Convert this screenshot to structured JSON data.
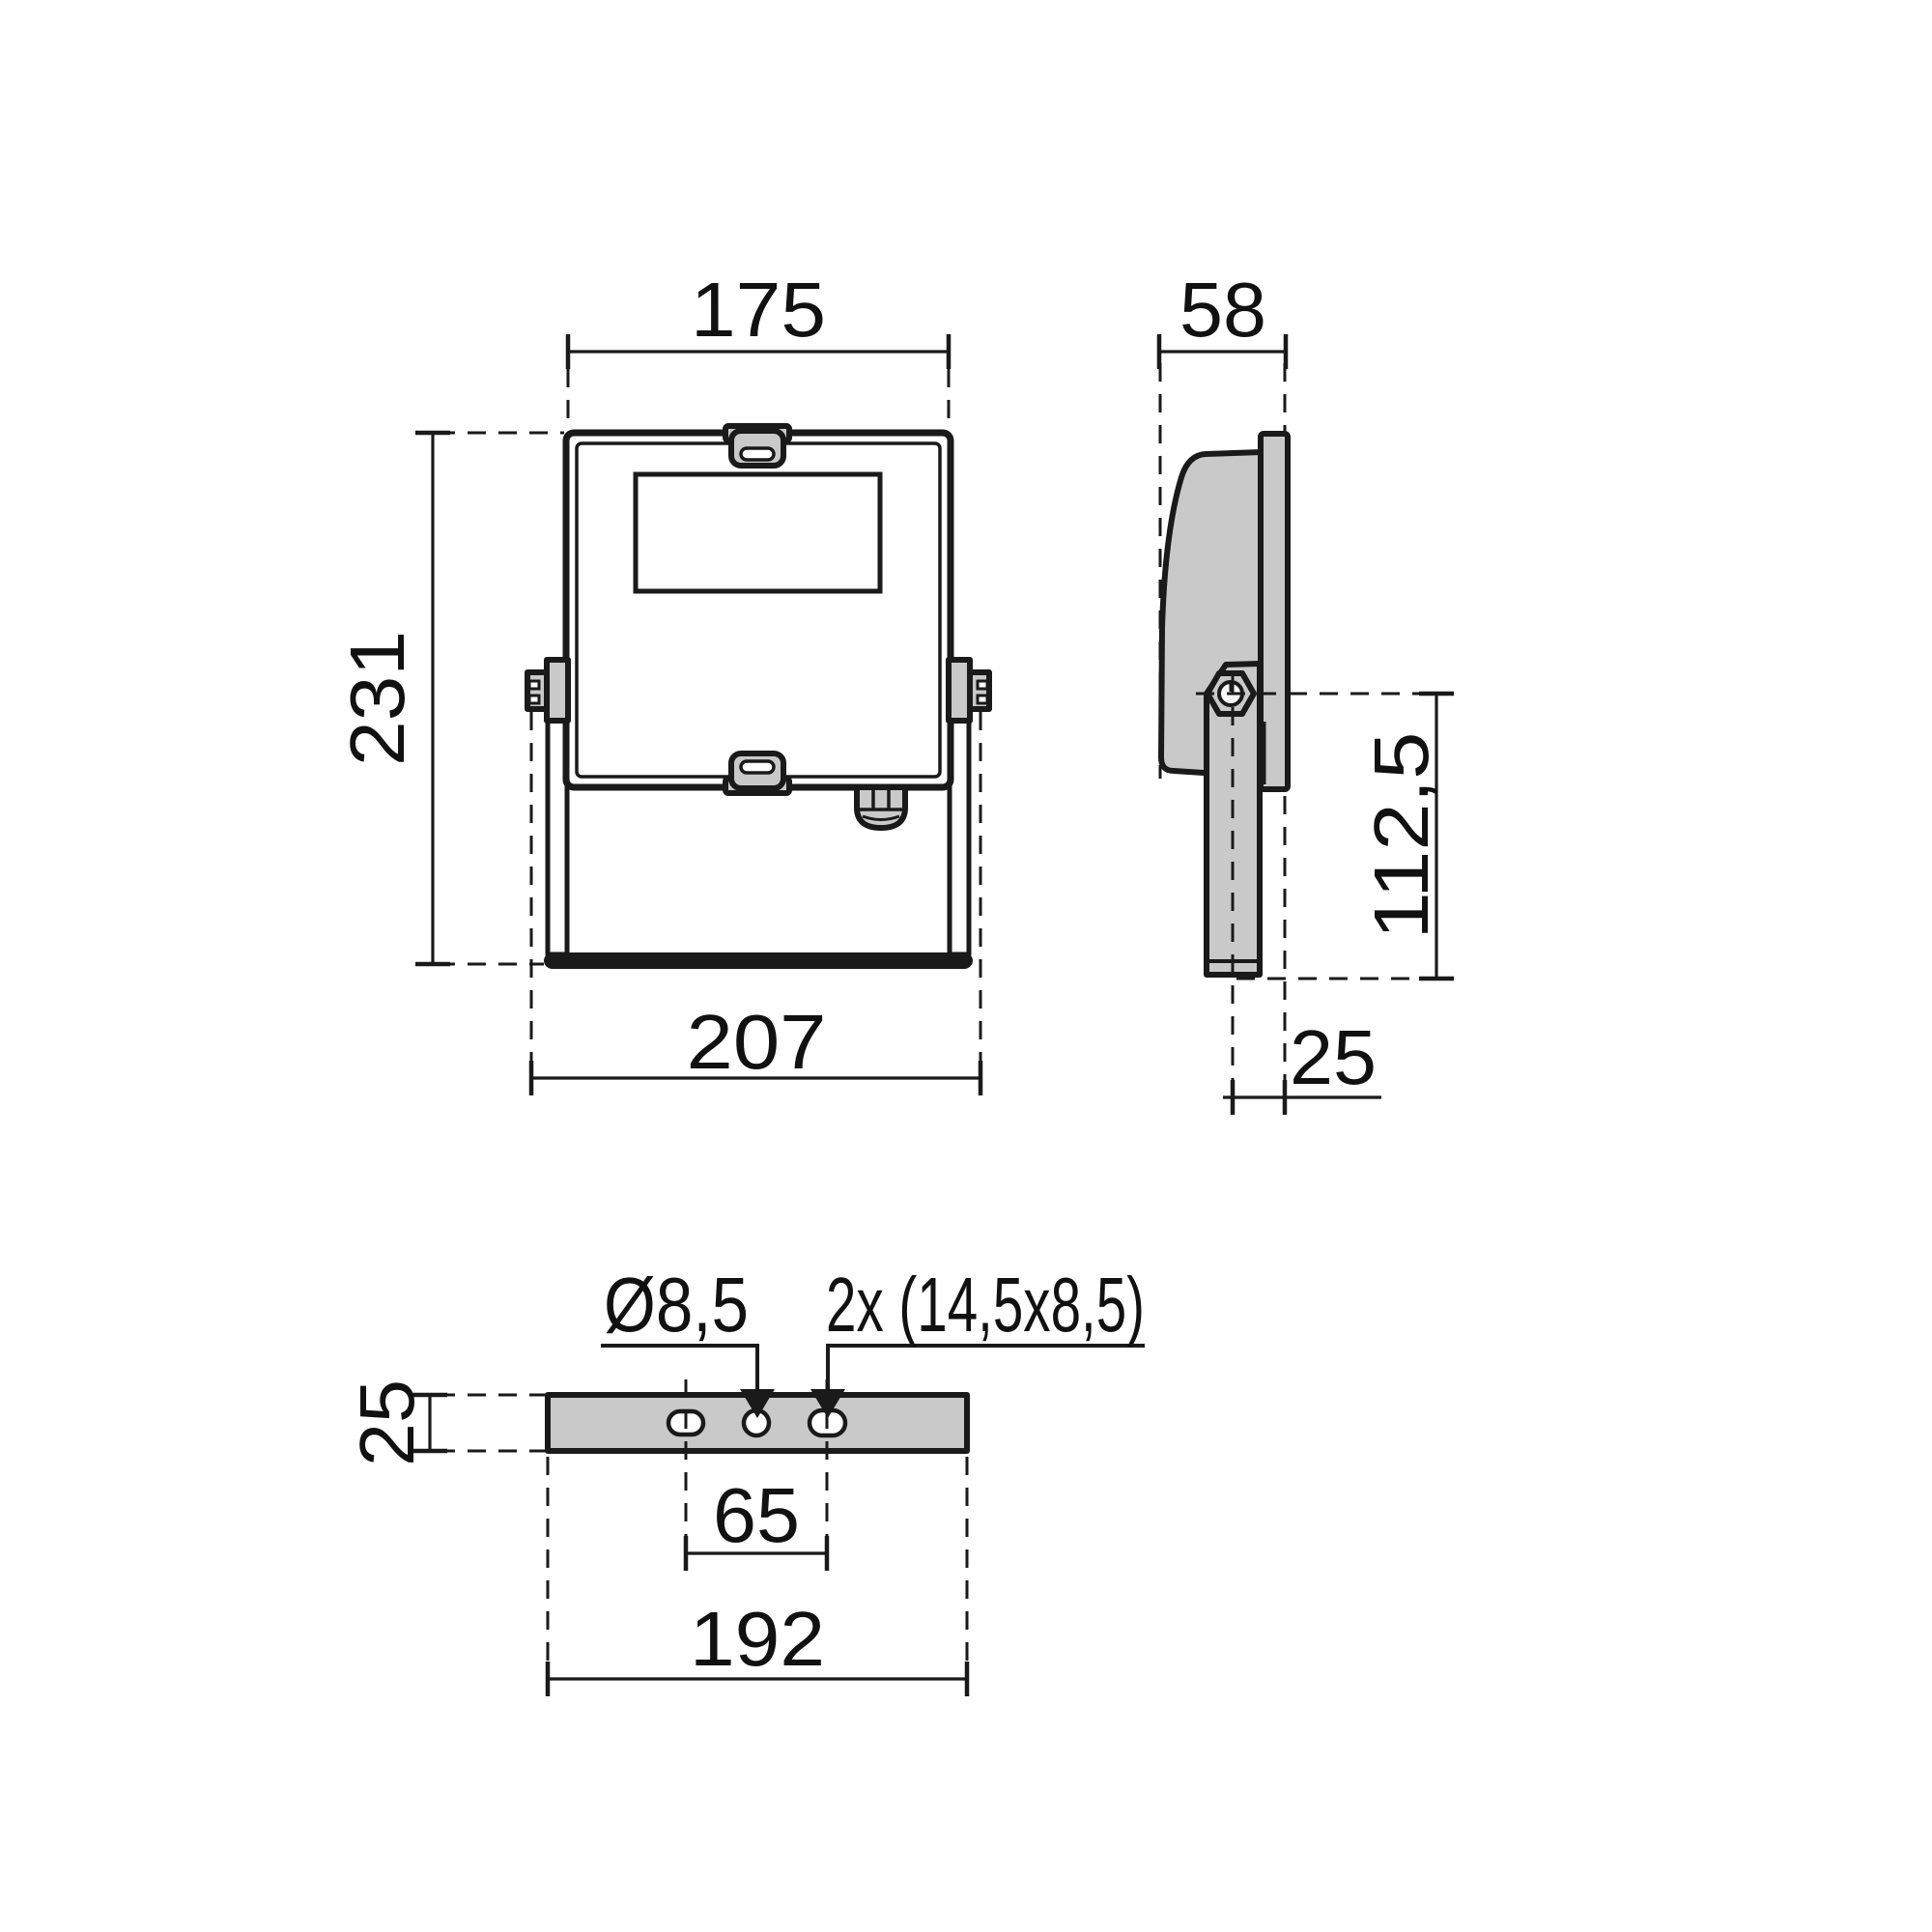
{
  "front_view": {
    "width_top": "175",
    "height": "231",
    "width_overall": "207"
  },
  "side_view": {
    "depth": "58",
    "pivot_to_arm_end": "112,5",
    "arm_offset": "25"
  },
  "bottom_view": {
    "thickness": "25",
    "center_hole": "Ø8,5",
    "slots": "2x (14,5x8,5)",
    "slot_spacing": "65",
    "length": "192"
  },
  "colors": {
    "line": "#1a1a1a",
    "part_fill": "#c9c9c9",
    "background": "#ffffff"
  }
}
